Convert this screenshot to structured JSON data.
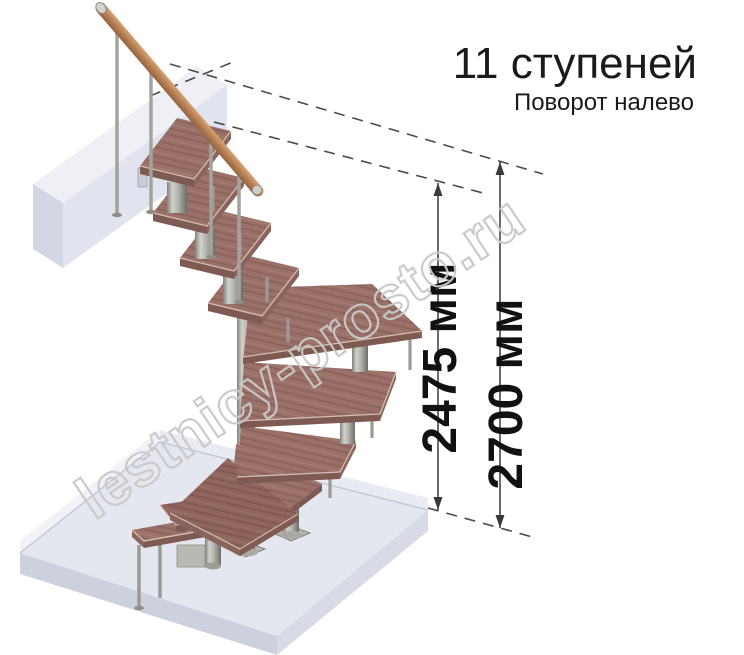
{
  "header": {
    "title": "11 ступеней",
    "subtitle": "Поворот налево"
  },
  "dimensions": {
    "inner": {
      "label": "2475 мм"
    },
    "outer": {
      "label": "2700 мм"
    }
  },
  "watermark": {
    "text": "lestnicy-prosto.ru"
  },
  "illustration": {
    "type": "3d-render-modular-staircase",
    "steps_count": 11,
    "turn_direction": "налево",
    "colors": {
      "tread_wood": "#9a7068",
      "tread_edge": "#7e5a52",
      "handrail_wood": "#b57d54",
      "metal": "#b2b2ac",
      "floor_slab": "#e4e7f0",
      "dimension_lines": "#3a3a3a",
      "text": "#1a1a1a",
      "watermark": "#c9c9c9"
    }
  }
}
